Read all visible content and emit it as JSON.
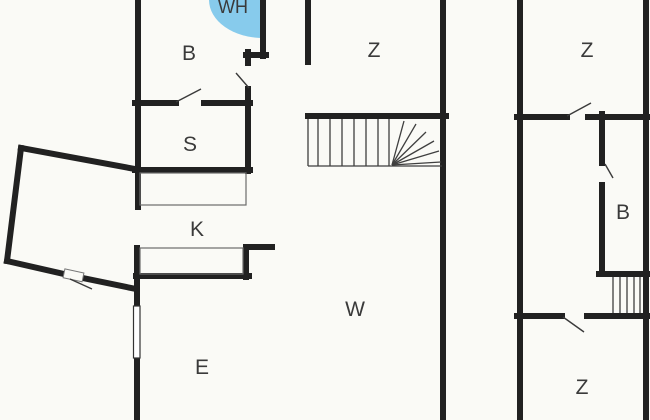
{
  "plan": {
    "type": "floor-plan",
    "colors": {
      "background": "#FAFAF6",
      "wall": "#212121",
      "stair_line": "#3F3F3F",
      "counter_line": "#6B6B6B",
      "door_line": "#3A3A3A",
      "window_line": "#333333",
      "water_heater": "#87CBEC",
      "label": "#3A3A3A"
    },
    "rooms": [
      {
        "id": "water-heater",
        "label": "WH"
      },
      {
        "id": "bathroom-main",
        "label": "B"
      },
      {
        "id": "bedroom-mid-top",
        "label": "Z"
      },
      {
        "id": "bedroom-right-top",
        "label": "Z"
      },
      {
        "id": "storage",
        "label": "S"
      },
      {
        "id": "kitchen",
        "label": "K"
      },
      {
        "id": "bathroom-right",
        "label": "B"
      },
      {
        "id": "living-room",
        "label": "W"
      },
      {
        "id": "dining-room",
        "label": "E"
      },
      {
        "id": "bedroom-right-bottom",
        "label": "Z"
      }
    ]
  }
}
